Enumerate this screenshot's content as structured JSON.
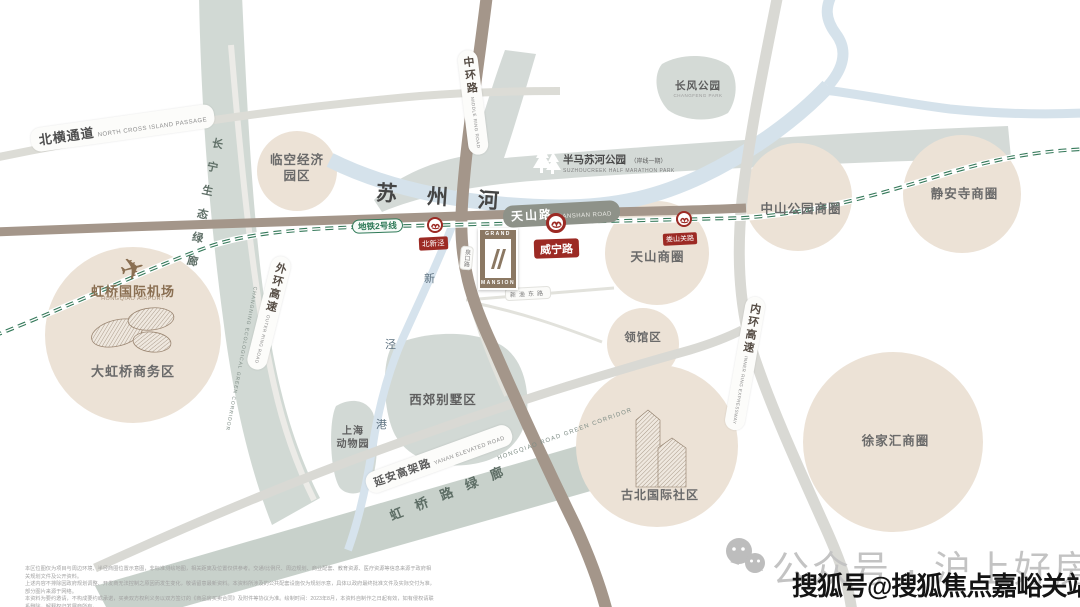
{
  "map": {
    "roads": {
      "north_cross": {
        "zh": "北横通道",
        "en": "NORTH CROSS ISLAND PASSAGE"
      },
      "middle_ring": {
        "zh": "中环路",
        "en": "MIDDLE RING ROAD"
      },
      "outer_ring": {
        "zh": "外环高速",
        "en": "OUTER RING ROAD"
      },
      "inner_ring": {
        "zh": "内环高速",
        "en": "INNER RING EXPRESSWAY"
      },
      "tianshan": {
        "zh": "天山路",
        "en": "TIANSHAN ROAD"
      },
      "yanan": {
        "zh": "延安高架路",
        "en": "YANAN ELEVATED ROAD"
      },
      "xinyu": {
        "zh": "新渔东路"
      },
      "quankou": {
        "zh": "泉口路"
      }
    },
    "rivers": {
      "suzhou": "苏州河",
      "xinjing_chars": [
        "新",
        "泾",
        "港"
      ]
    },
    "metro": {
      "line_label": "地铁2号线",
      "stations": [
        {
          "name": "北新泾"
        },
        {
          "name": "威宁路"
        },
        {
          "name": "娄山关路"
        }
      ]
    },
    "corridors": {
      "changning": {
        "zh": "长宁生态绿廊",
        "en": "CHANGNING ECOLOGICAL GREEN CORRIDOR"
      },
      "hongqiao": {
        "zh": "虹桥路绿廊",
        "en": "HONGQIAO ROAD GREEN CORRIDOR"
      }
    },
    "parks": {
      "changfeng": {
        "zh": "长风公园",
        "en": "CHANGFENG PARK"
      },
      "banma": {
        "zh": "半马苏河公园",
        "note": "（岸线一期）",
        "en": "SUZHOUCREEK HALF MARATHON PARK"
      }
    },
    "airport": {
      "zh": "虹桥国际机场",
      "en": "HONGQIAO AIRPORT"
    },
    "areas": {
      "linkong": {
        "line1": "临空经济",
        "line2": "园区"
      },
      "dahongqiao": "大虹桥商务区",
      "tianshan_biz": "天山商圈",
      "zhongshan_biz": "中山公园商圈",
      "jingan_biz": "静安寺商圈",
      "lingguan": "领馆区",
      "xujiahui_biz": "徐家汇商圈",
      "gubei": "古北国际社区",
      "xijiao": "西郊别墅区",
      "zoo": {
        "line1": "上海",
        "line2": "动物园"
      }
    },
    "project": {
      "top": "GRAND",
      "bottom": "MANSION"
    }
  },
  "watermarks": {
    "wechat": "公众号 · 沪上好房通",
    "sohu": "搜狐号@搜狐焦点嘉峪关站"
  },
  "disclaimer": {
    "lines": [
      "本区位图仅为项目与周边环境、半径商圈位置示意图，非标准测绘地图，相关距离及位置仅供参考。交通/比例尺、周边规划、商业配套、教育资源、医疗资源等信息来源于政府相关规划文件及公开资料。",
      "上述内容不排除因政府规划调整、开发商无法控制之原因而发生变化，敬请留意最新资料。本资料所涉及的公共配套设施仅为规划示意，具体以政府最终批准文件及实际交付为准，部分图片来源于网络。",
      "本资料为要约邀请，不构成要约或承诺，买卖双方权利义务以双方签订的《商品房买卖合同》及附件等协议为准。绘制时间：2023年8月，本资料自制作之日起有效，如有侵权请联系删除，解释权归发展商所有。"
    ]
  }
}
